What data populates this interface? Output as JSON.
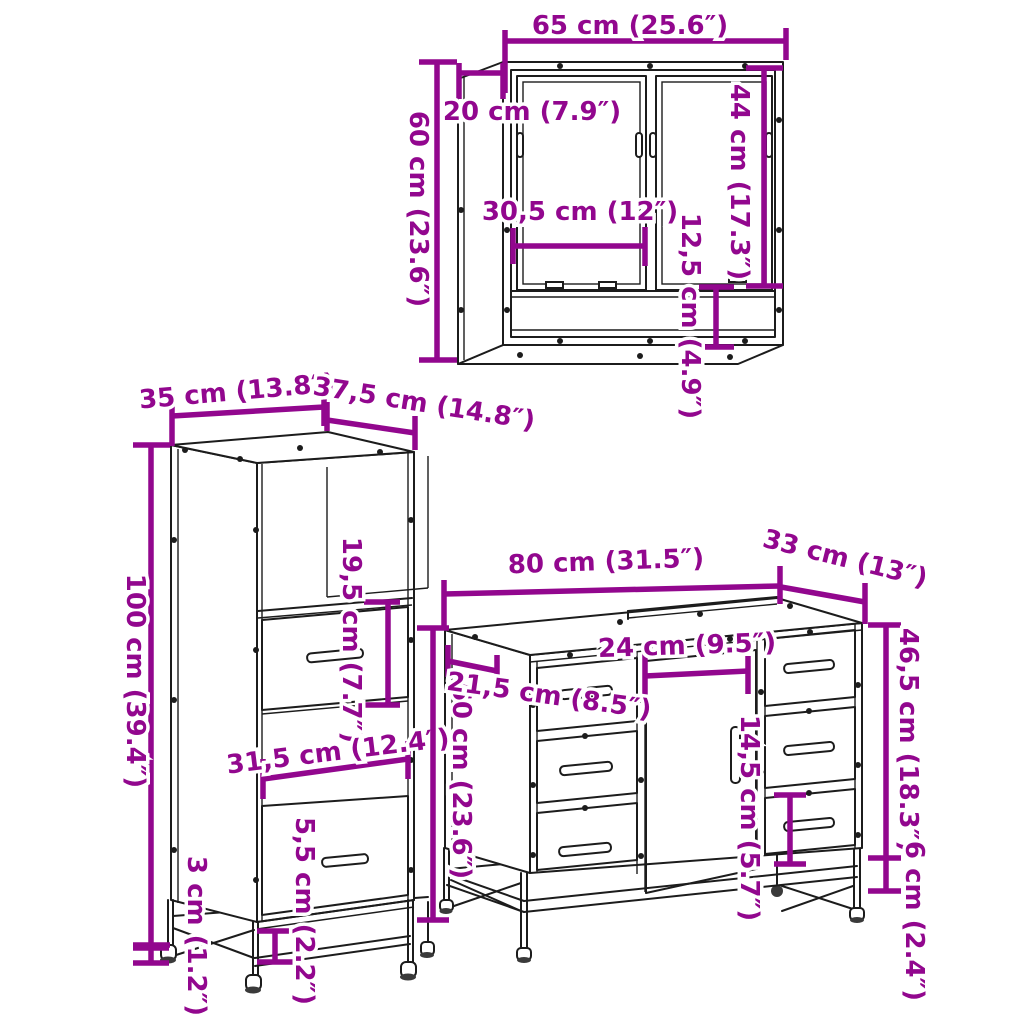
{
  "accent_color": "#92078E",
  "line_color": "#1c1c1c",
  "diagram": {
    "mirror_cabinet": {
      "width": "65 cm (25.6″)",
      "depth": "20 cm (7.9″)",
      "height": "60 cm (23.6″)",
      "door_height": "44 cm (17.3″)",
      "door_width": "30,5 cm (12″)",
      "shelf_gap": "12,5 cm (4.9″)"
    },
    "tall_cabinet": {
      "width": "35 cm (13.8″)",
      "depth": "37,5 cm (14.8″)",
      "height": "100 cm (39.4″)",
      "drawer_height": "19,5 cm (7.7″)",
      "inner_width": "31,5 cm (12.4″)",
      "bottom_clearance": "5,5 cm (2.2″)",
      "foot_height": "3 cm (1.2″)"
    },
    "vanity_cabinet": {
      "width": "80 cm (31.5″)",
      "depth": "33 cm (13″)",
      "height": "60 cm (23.6″)",
      "side_depth": "21,5 cm (8.5″)",
      "opening_width": "24 cm (9.5″)",
      "right_height": "46,5 cm (18.3″)",
      "door_inset": "14,5 cm (5.7″)",
      "frame_height": "6 cm (2.4″)"
    }
  }
}
